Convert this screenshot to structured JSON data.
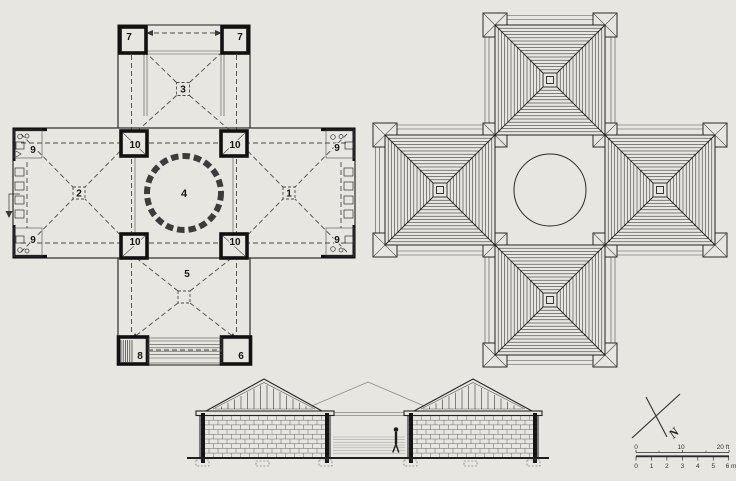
{
  "floor_plan": {
    "rooms": {
      "r1": "1",
      "r2": "2",
      "r3": "3",
      "r4": "4",
      "r5": "5",
      "r6": "6",
      "r7": "7",
      "r8": "8",
      "r9": "9",
      "r10": "10"
    }
  },
  "compass": {
    "north": "N"
  },
  "scale": {
    "feet": [
      "0",
      "10",
      "20 ft"
    ],
    "meters": [
      "0",
      "1",
      "2",
      "3",
      "4",
      "5",
      "6 m"
    ]
  },
  "colors": {
    "paper": "#e8e6e0",
    "ink": "#1c1c1c",
    "wall": "#111111",
    "dash": "#4a4a4a",
    "hatch": "#2b2b2b",
    "light": "#8a8a8a"
  }
}
